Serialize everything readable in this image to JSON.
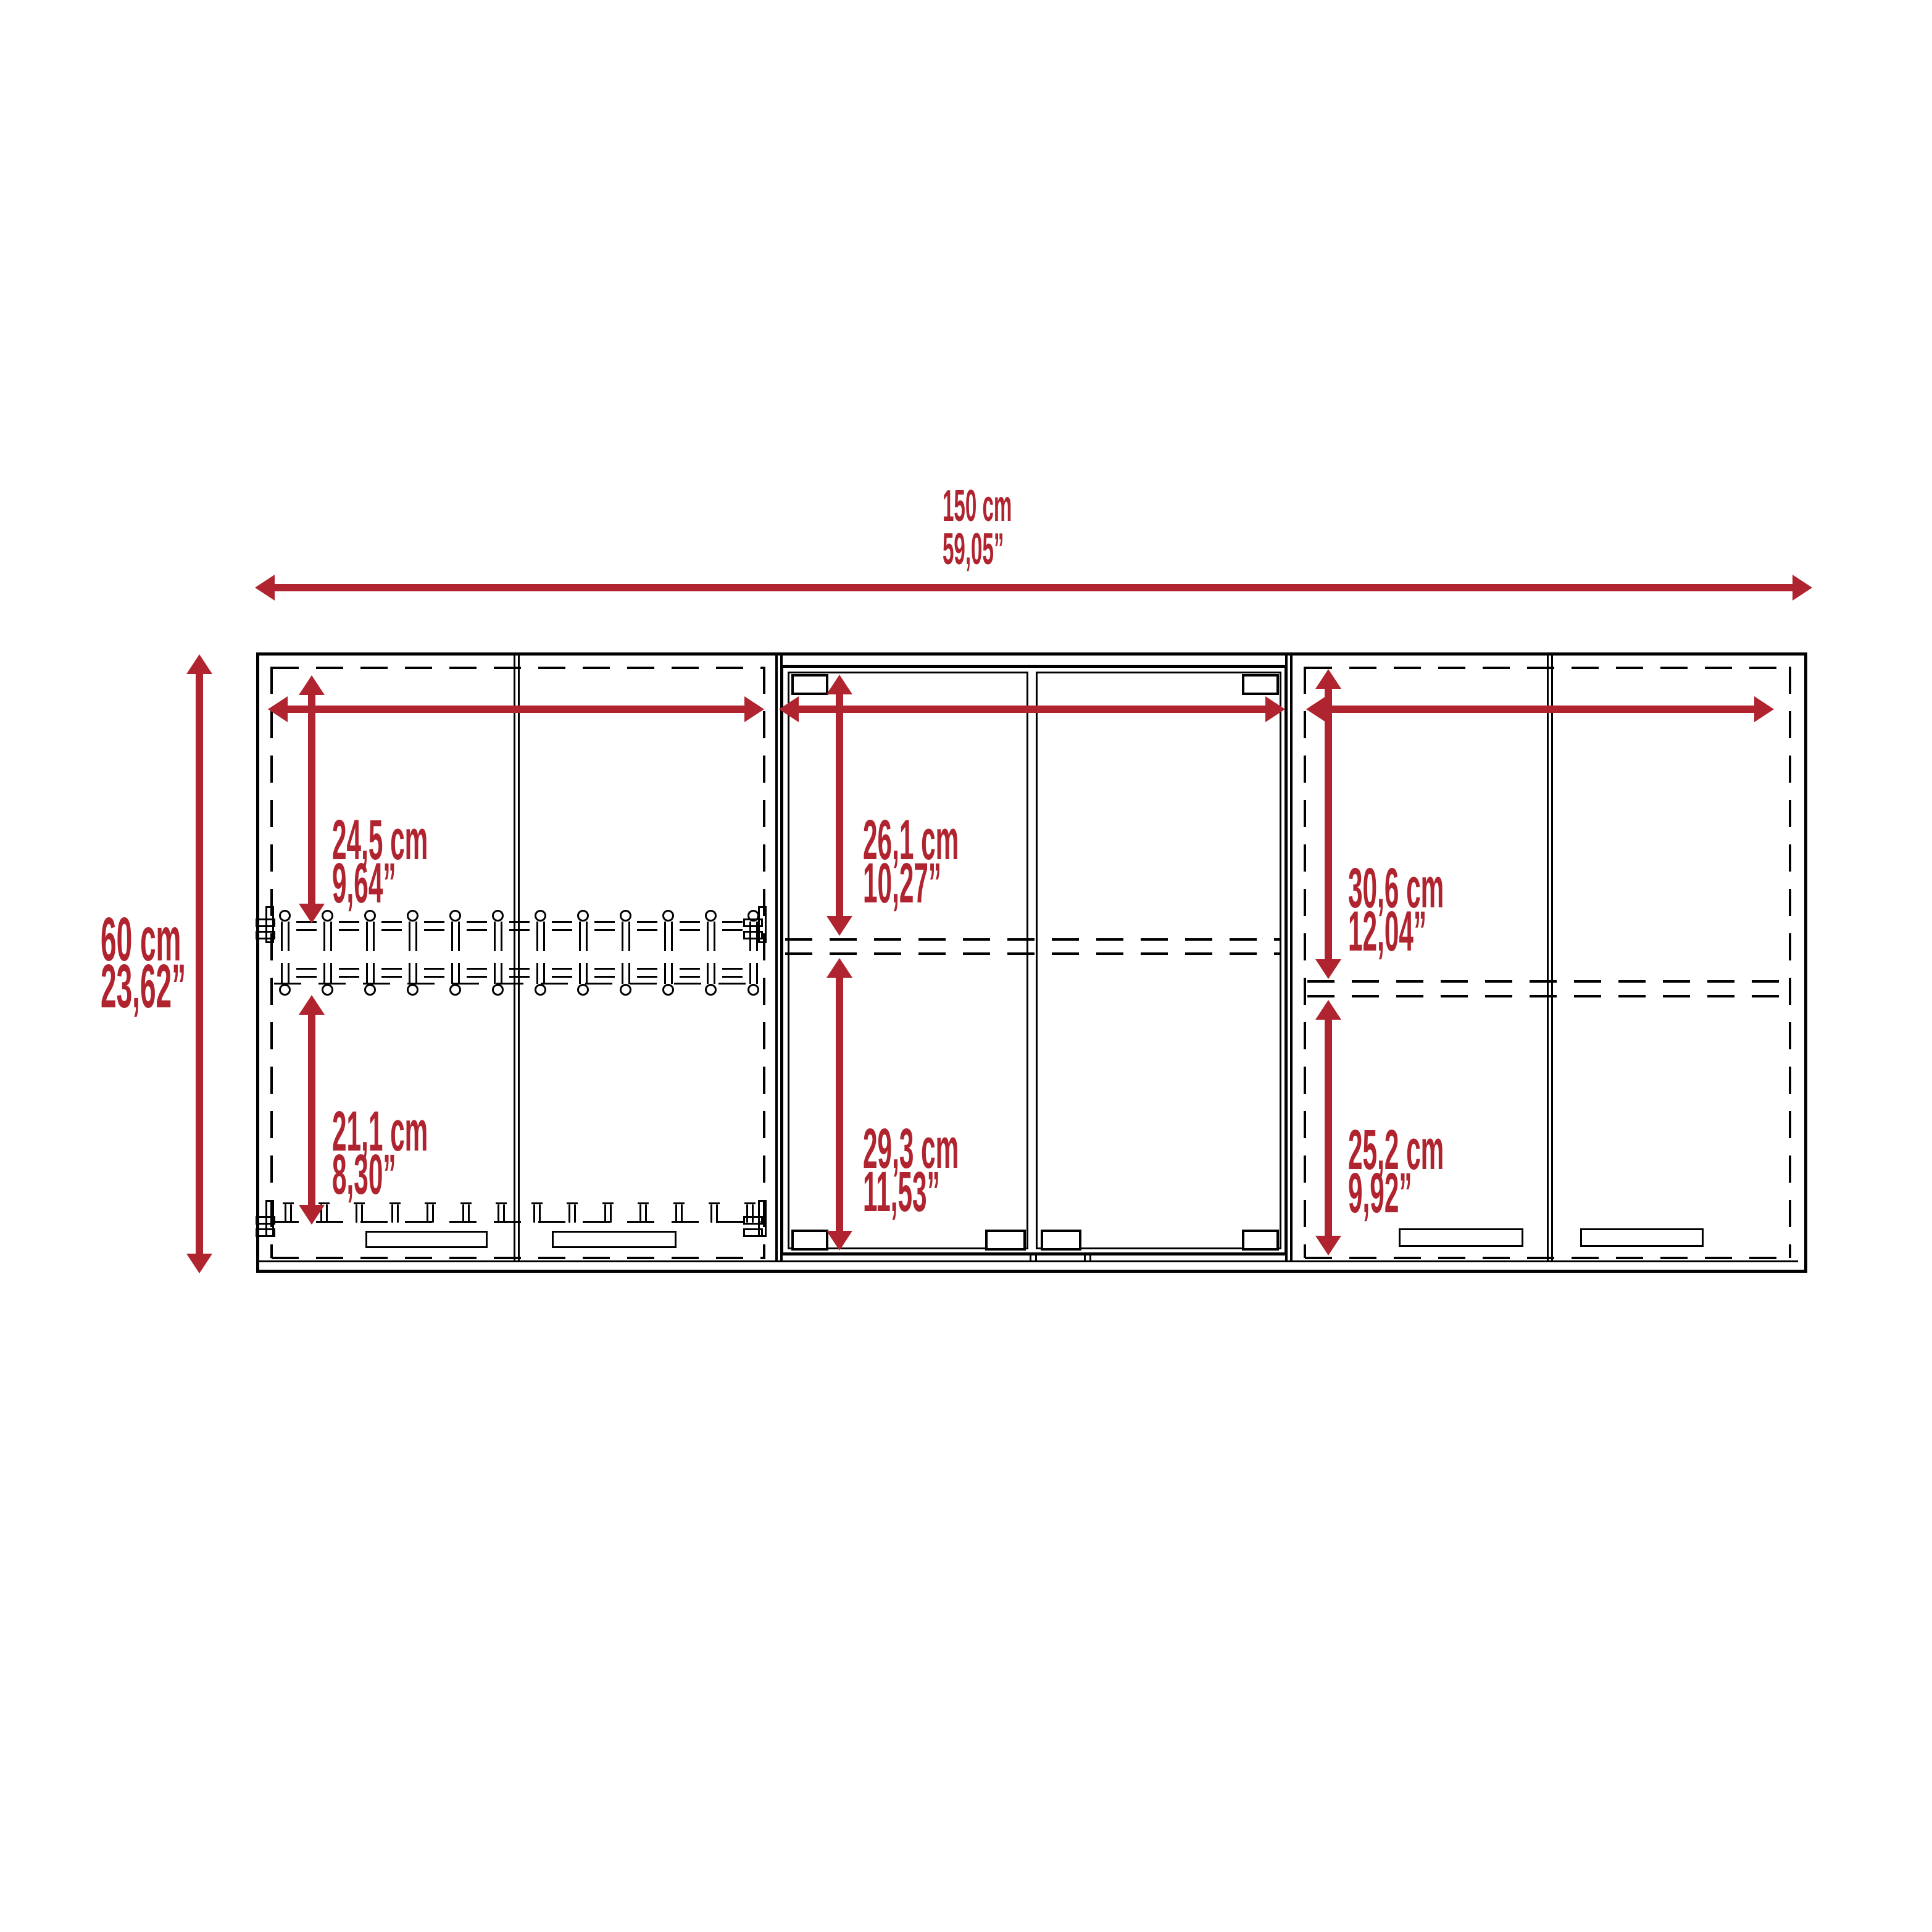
{
  "colors": {
    "dimension_red": "#b0242f",
    "line_black": "#000000",
    "background": "#ffffff"
  },
  "dimensions": {
    "overall_width": {
      "metric": "150 cm",
      "imperial": "59,05”"
    },
    "overall_height": {
      "metric": "60 cm",
      "imperial": "23,62”"
    },
    "left_top": {
      "metric": "24,5 cm",
      "imperial": "9,64”"
    },
    "left_bottom": {
      "metric": "21,1 cm",
      "imperial": "8,30”"
    },
    "middle_top": {
      "metric": "26,1 cm",
      "imperial": "10,27”"
    },
    "middle_bottom": {
      "metric": "29,3 cm",
      "imperial": "11,53”"
    },
    "right_top": {
      "metric": "30,6 cm",
      "imperial": "12,04”"
    },
    "right_bottom": {
      "metric": "25,2 cm",
      "imperial": "9,92”"
    }
  },
  "racks": {
    "upper_units": 12,
    "lower_units": 12,
    "bottom_hooks": 14
  }
}
